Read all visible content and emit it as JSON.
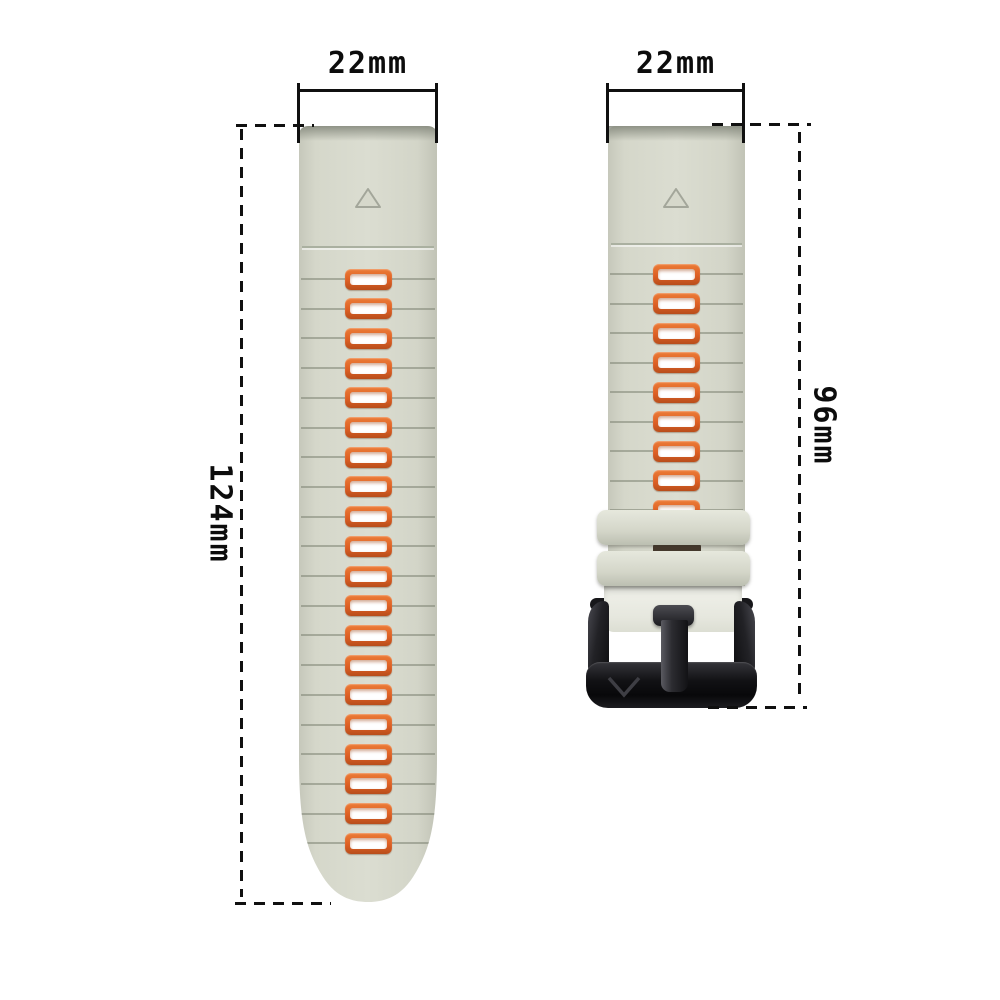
{
  "annotations": {
    "left_width": {
      "label": "22mm"
    },
    "right_width": {
      "label": "22mm"
    },
    "left_length": {
      "label": "124mm"
    },
    "right_length": {
      "label": "96mm"
    }
  },
  "straps": {
    "left": {
      "slot_count": 20,
      "slot_pitch_px": 29.7,
      "first_slot_center_y": 153
    },
    "right": {
      "slot_count": 9,
      "slot_pitch_px": 29.5,
      "first_slot_center_y": 148
    }
  },
  "icons": [
    "triangle-up-icon",
    "triangle-up-icon",
    "buckle-v-logo-icon"
  ],
  "colors": {
    "background": "#ffffff",
    "strap_base": "#d7d9cc",
    "slot_orange": "#dd5f24",
    "slot_orange_light": "#ec7c37",
    "slot_orange_dark": "#b84d1b",
    "slot_inner": "#ffffff",
    "buckle_black": "#141416",
    "annotation_ink": "#0c0c0c"
  }
}
